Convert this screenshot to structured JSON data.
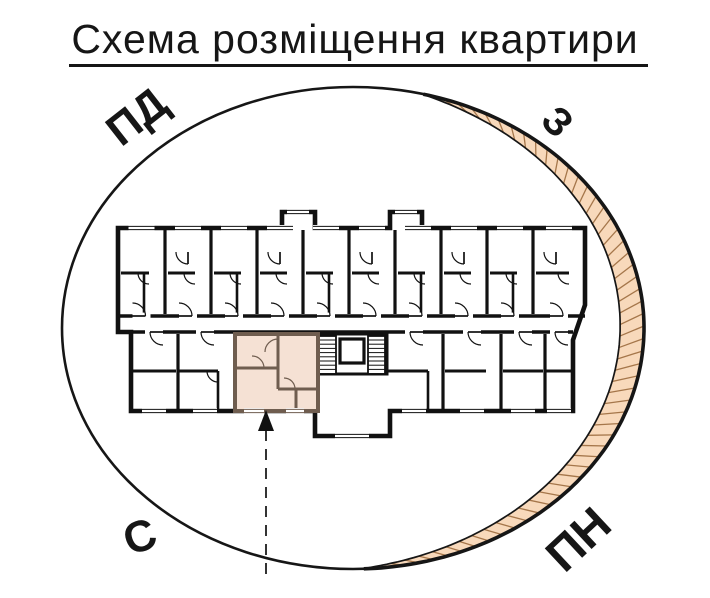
{
  "title": {
    "text": "Схема розміщення квартири"
  },
  "compass": {
    "labels": [
      {
        "text": "ПД",
        "position": "top-left",
        "color": "#161616"
      },
      {
        "text": "З",
        "position": "top-right",
        "color": "#161616"
      },
      {
        "text": "С",
        "position": "bottom-left",
        "color": "#161616"
      },
      {
        "text": "ПН",
        "position": "bottom-right",
        "color": "#a5722b"
      }
    ]
  },
  "diagram": {
    "outline_color": "#161616",
    "crescent_fill": "#f8d9bb",
    "crescent_hatch": "#a5764a",
    "highlight_fill": "#f5e1d4",
    "highlight_wall": "#6f5d4f",
    "plan_wall": "#111111"
  }
}
